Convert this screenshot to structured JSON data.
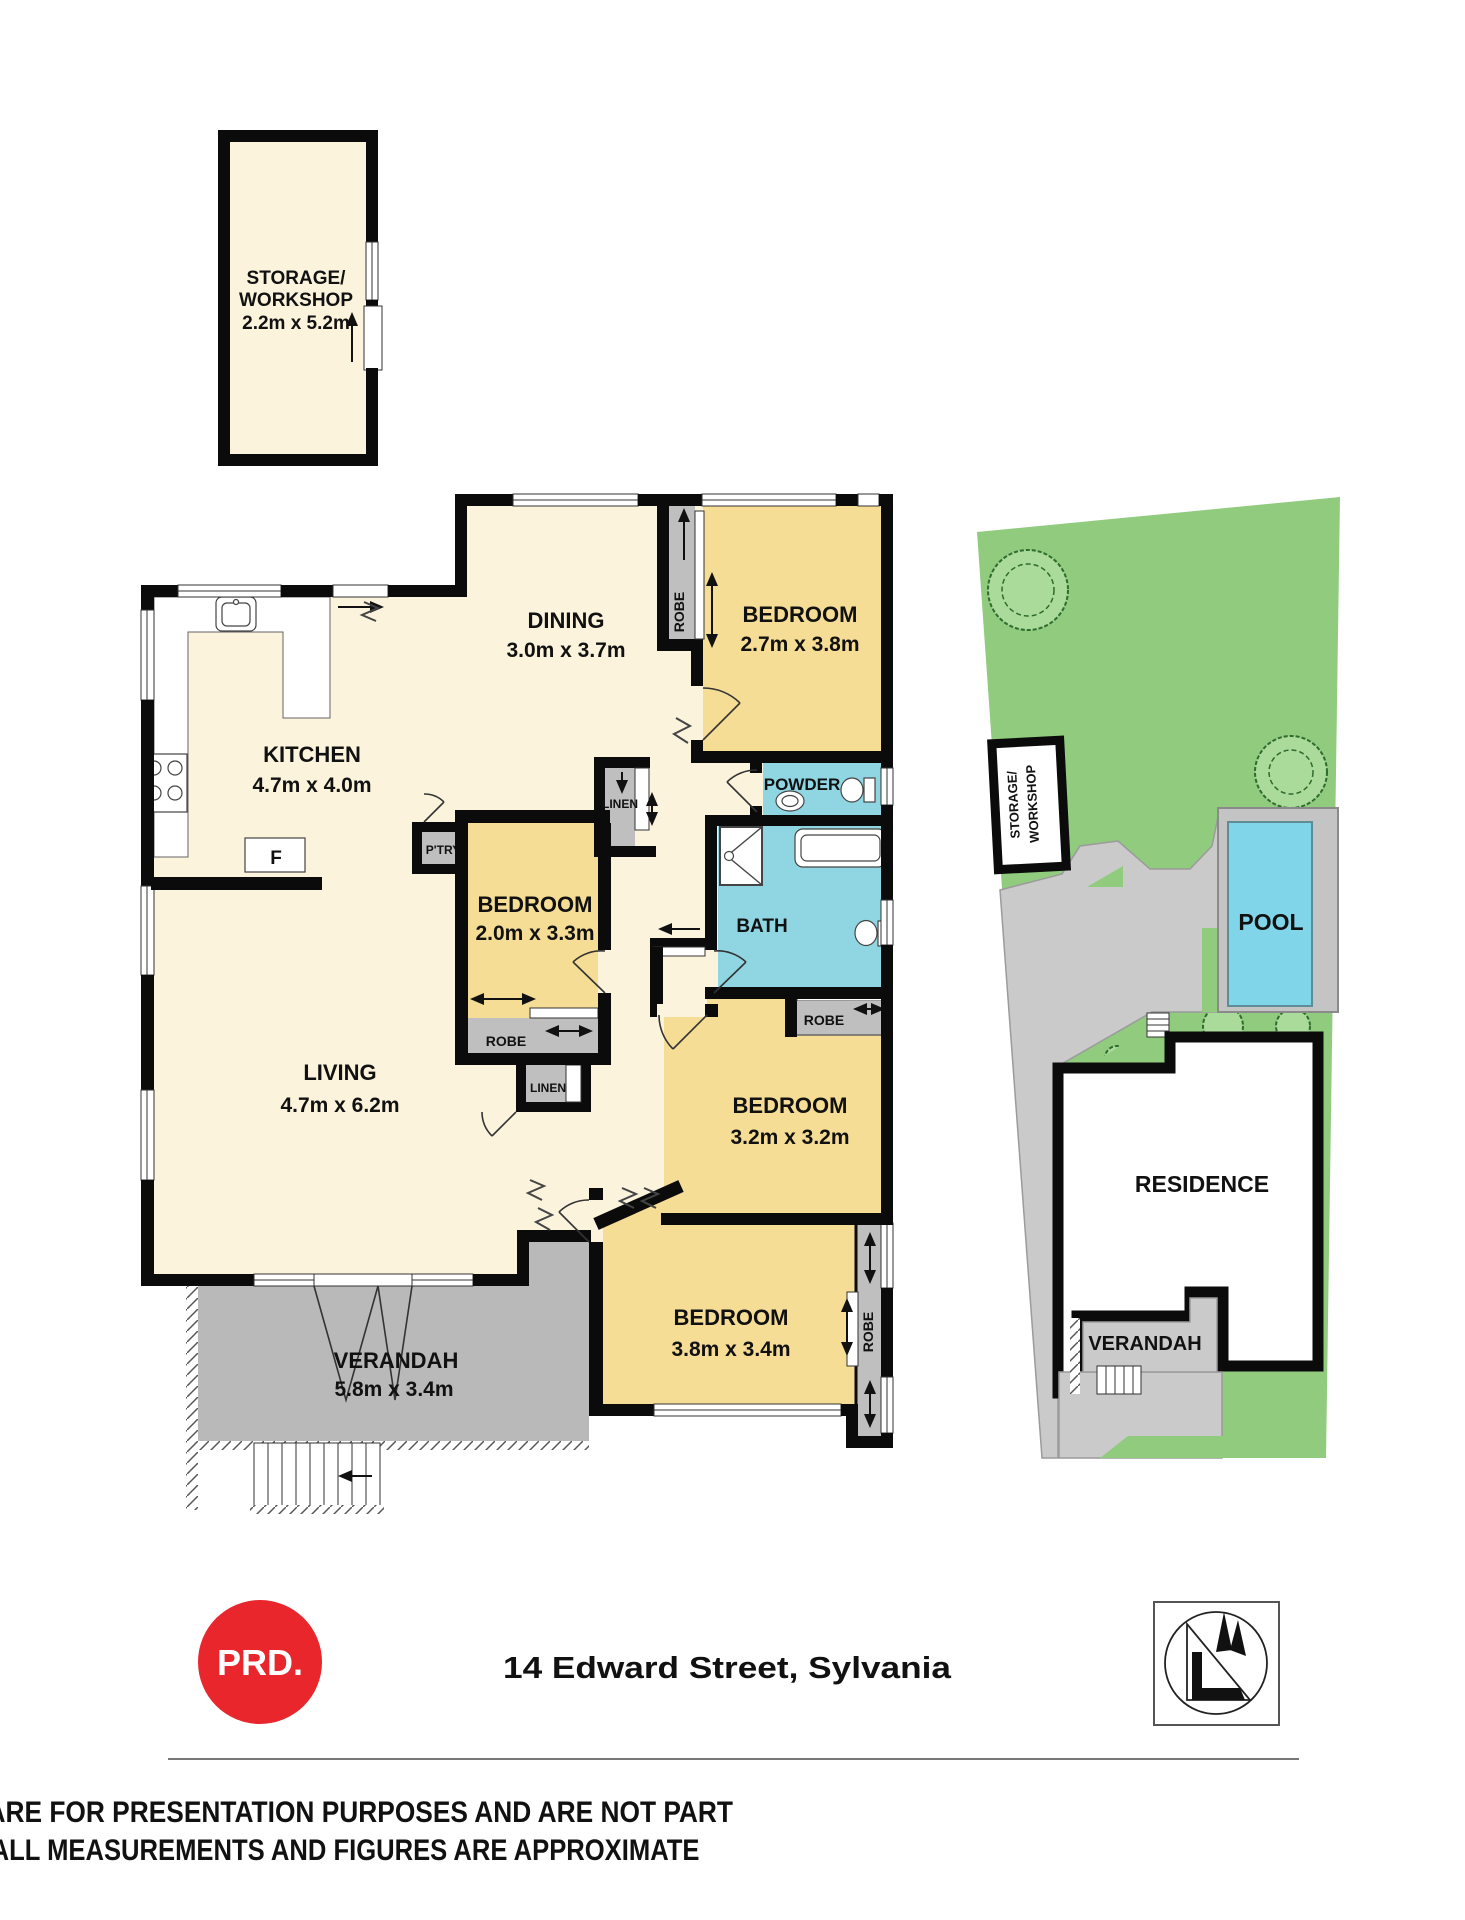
{
  "plan": {
    "storage": {
      "line1": "STORAGE/",
      "line2": "WORKSHOP",
      "dims": "2.2m x 5.2m"
    },
    "dining": {
      "name": "DINING",
      "dims": "3.0m x 3.7m"
    },
    "kitchen": {
      "name": "KITCHEN",
      "dims": "4.7m x 4.0m"
    },
    "bed27": {
      "name": "BEDROOM",
      "dims": "2.7m x 3.8m"
    },
    "bed20": {
      "name": "BEDROOM",
      "dims": "2.0m x 3.3m"
    },
    "bed32": {
      "name": "BEDROOM",
      "dims": "3.2m x 3.2m"
    },
    "bed38": {
      "name": "BEDROOM",
      "dims": "3.8m x 3.4m"
    },
    "living": {
      "name": "LIVING",
      "dims": "4.7m x 6.2m"
    },
    "verandah": {
      "name": "VERANDAH",
      "dims": "5.8m x 3.4m"
    },
    "powder": {
      "name": "POWDER"
    },
    "bath": {
      "name": "BATH"
    },
    "small": {
      "robe": "ROBE",
      "linen": "LINEN",
      "pantry": "P'TRY",
      "fridge": "F"
    }
  },
  "site": {
    "pool": "POOL",
    "residence": "RESIDENCE",
    "verandah": "VERANDAH",
    "storage_line1": "STORAGE/",
    "storage_line2": "WORKSHOP"
  },
  "footer": {
    "logo": "PRD.",
    "address": "14 Edward Street, Sylvania",
    "disclaimer_line1": "DISCLAIMER: PLANS SHOWN ARE FOR PRESENTATION PURPOSES AND ARE NOT PART",
    "disclaimer_line2": "OF ANY LEGAL DOCUMENT. ALL MEASUREMENTS AND FIGURES ARE APPROXIMATE"
  },
  "colors": {
    "cream": "#FBF3DC",
    "yellow": "#F6DD95",
    "cyan": "#8FD6E2",
    "gray": "#BFBFBF",
    "vgray": "#B9B9B9",
    "drive": "#CACACA",
    "lawn": "#90CB7E",
    "tree": "#ABDB9B",
    "pool": "#80D6E8",
    "brand_red": "#E8262C",
    "wall": "#0B0B0B"
  }
}
